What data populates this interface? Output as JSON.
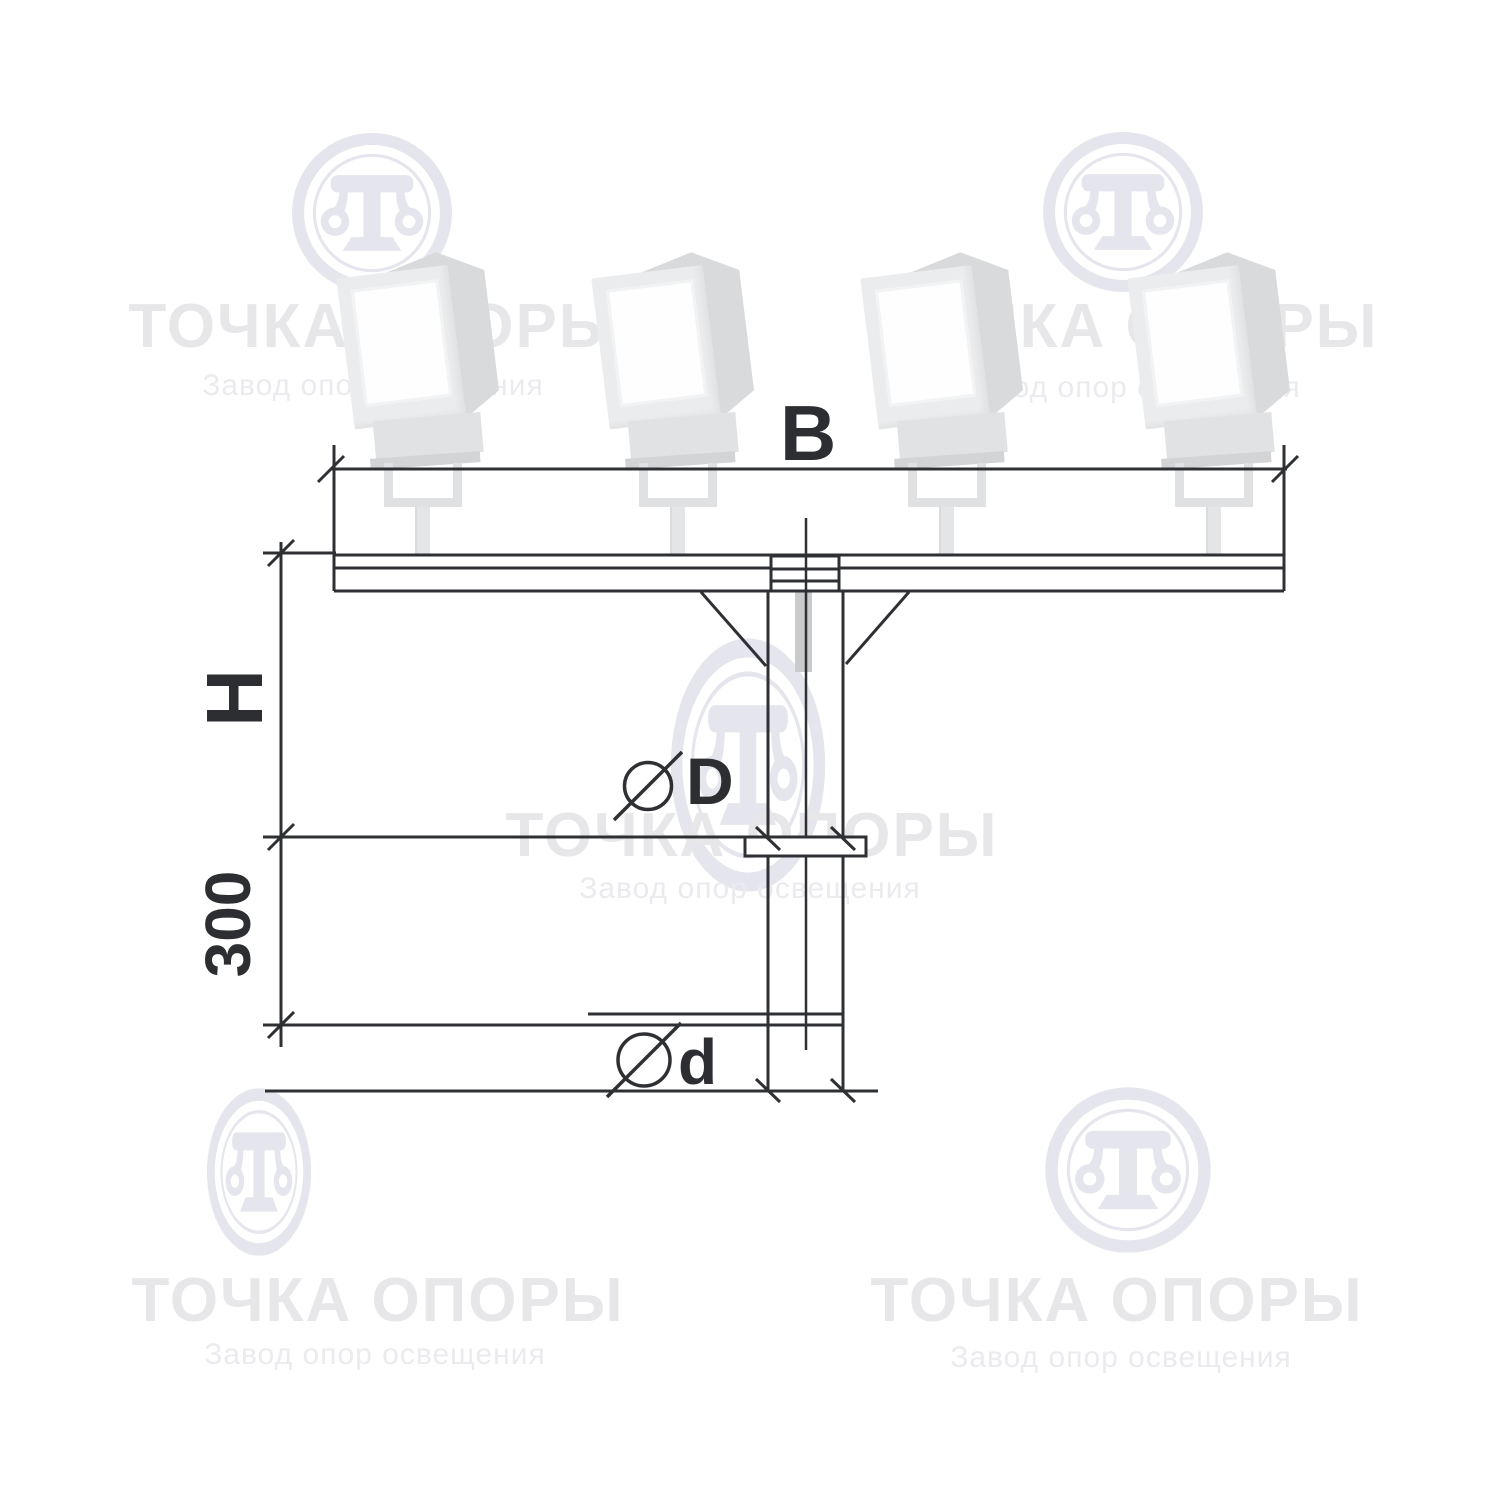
{
  "watermark": {
    "title": "ТОЧКА ОПОРЫ",
    "subtitle": "Завод опор освещения"
  },
  "dimensions": {
    "span_label": "B",
    "height_label": "H",
    "flange_offset_label": "300",
    "shaft_diameter_label": "D",
    "base_diameter_label": "d"
  },
  "drawing_info": {
    "floodlight_count": 4,
    "diameter_symbol": "⌀"
  },
  "colors": {
    "line": "#2e3033",
    "label_text": "#2c2e31",
    "watermark_title": "#e7e7ea",
    "watermark_subtitle": "#ebebef",
    "watermark_logo": "#e5e6ed",
    "lamp_body": "#ebeced",
    "lamp_side": "#d8dadc",
    "inner_tube": "#c9cacc"
  }
}
